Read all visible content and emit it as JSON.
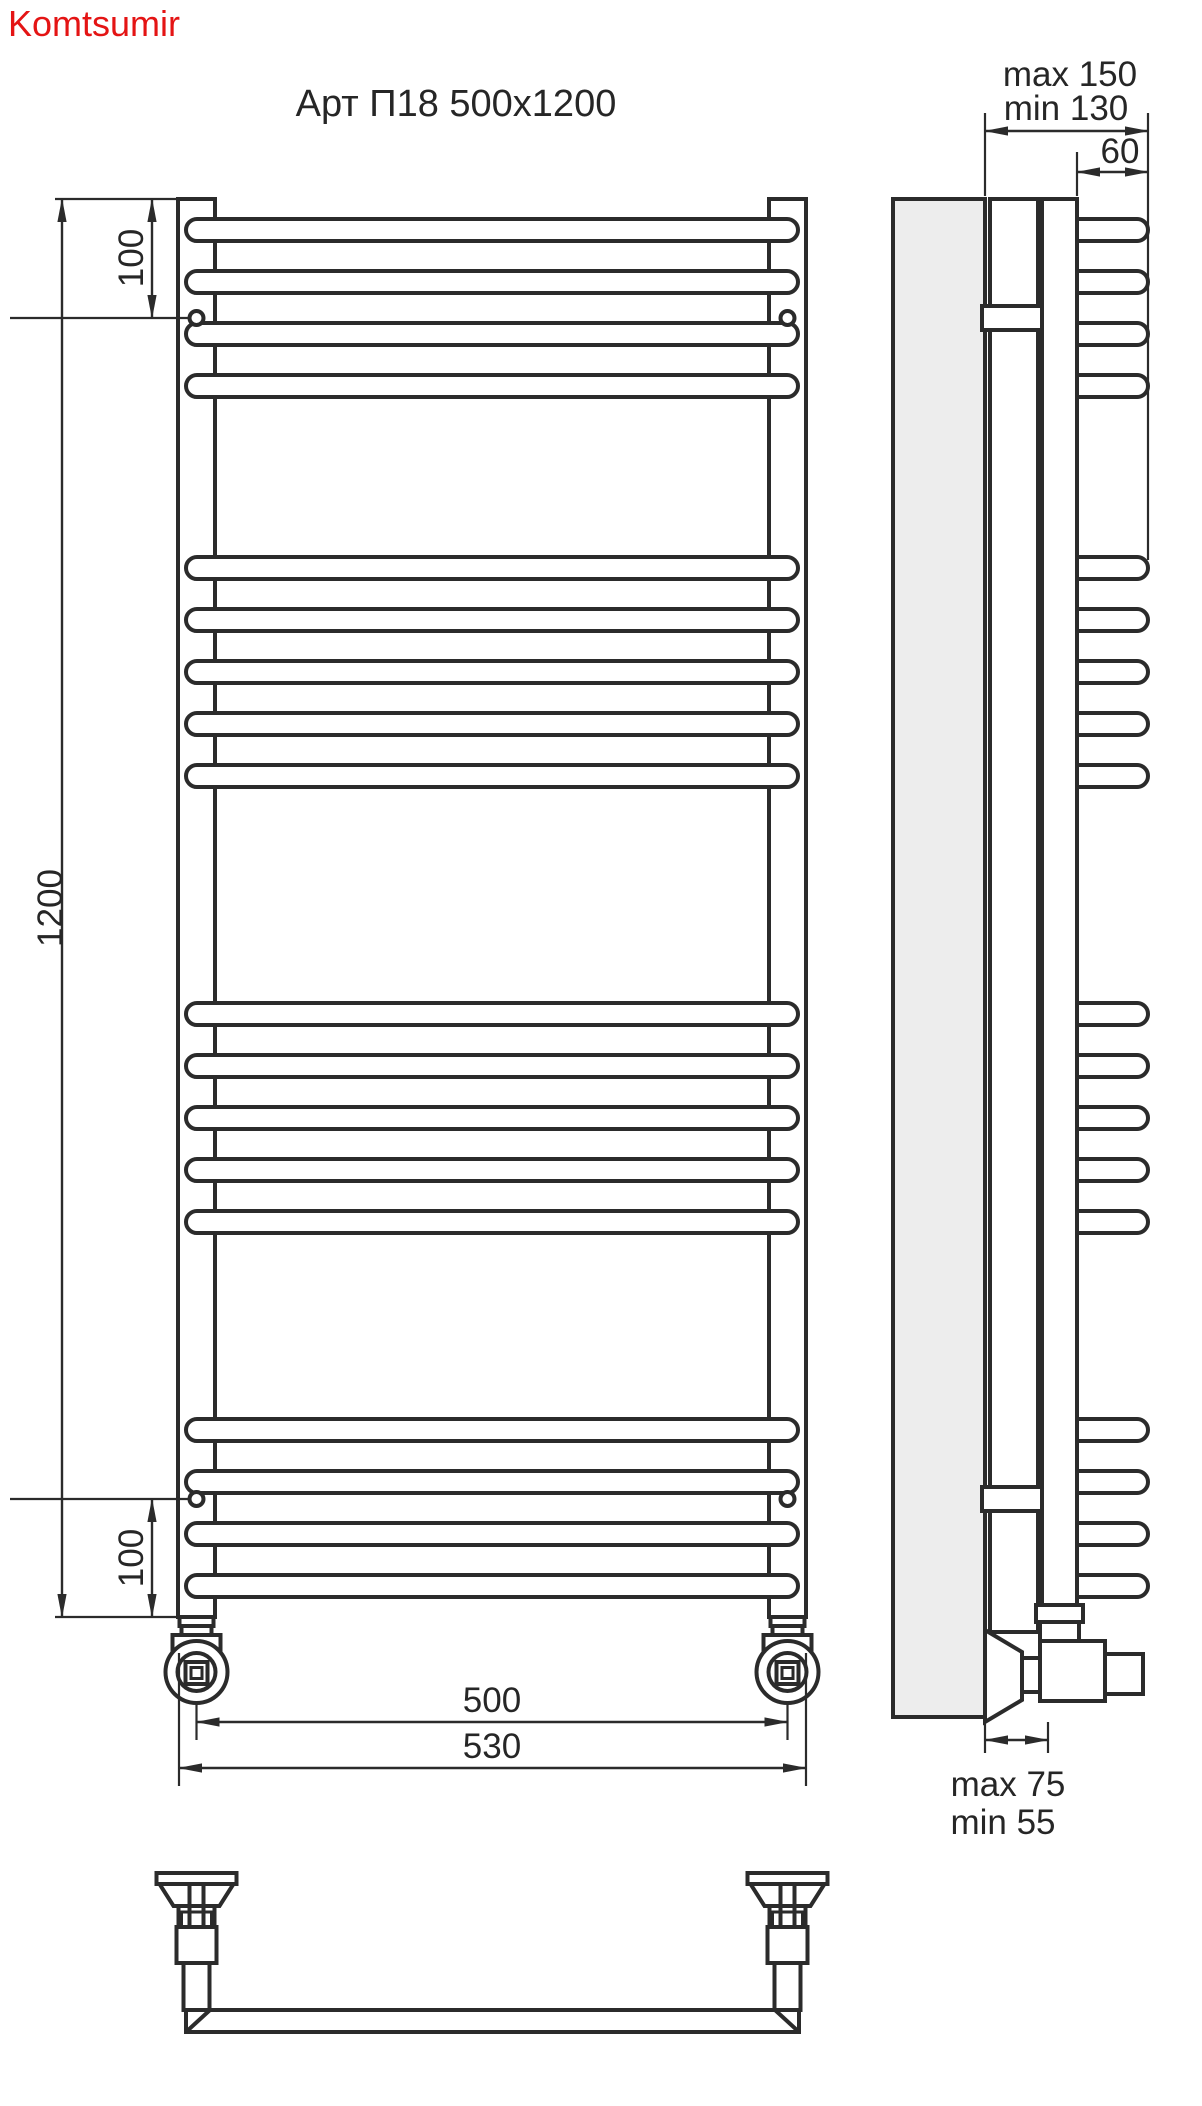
{
  "brand": "Komtsumir",
  "title": "Арт П18 500х1200",
  "front_view": {
    "dim_height": "1200",
    "dim_top_offset": "100",
    "dim_bottom_offset": "100",
    "dim_center_distance": "500",
    "dim_outer_width": "530"
  },
  "side_view": {
    "dim_wall_max": "max 150",
    "dim_wall_min": "min 130",
    "dim_bar_offset": "60",
    "dim_conn_max": "max 75",
    "dim_conn_min": "min 55"
  },
  "bars": {
    "count": 18,
    "thickness": 22,
    "pitch": 52,
    "groups": [
      {
        "start": 230,
        "count": 4
      },
      {
        "start": 568,
        "count": 5
      },
      {
        "start": 1014,
        "count": 5
      },
      {
        "start": 1430,
        "count": 4
      }
    ]
  },
  "mount_holes": {
    "top_y": 318,
    "bottom_y": 1499
  },
  "colors": {
    "brand": "#e41414",
    "line": "#2b2b2b",
    "wall_fill": "#ededed",
    "background": "#ffffff"
  }
}
